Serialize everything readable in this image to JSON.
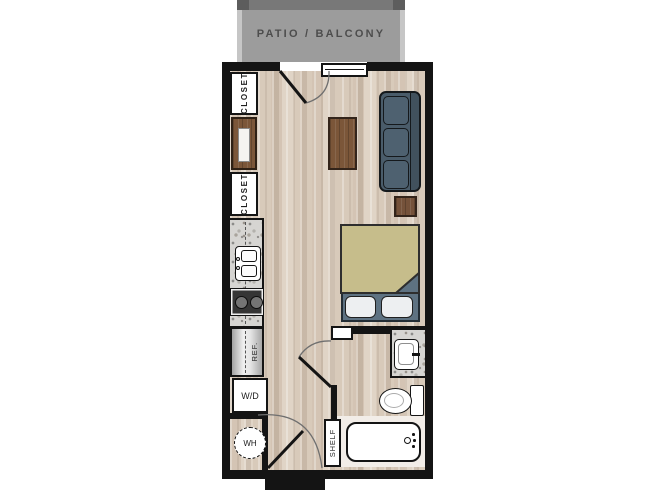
{
  "plan": {
    "patio": {
      "label": "PATIO / BALCONY"
    },
    "closets": [
      {
        "label": "CLOSET"
      },
      {
        "label": "CLOSET"
      }
    ],
    "kitchen": {
      "refrigerator_label": "REF.",
      "washer_dryer_label": "W/D",
      "water_heater_label": "WH"
    },
    "bathroom": {
      "shelf_label": "SHELF"
    }
  },
  "colors": {
    "wall": "#141414",
    "floor_base": "#dccfc0",
    "granite": "#d6d5d2",
    "patio_fill": "#9c9c9c",
    "patio_band": "#787878",
    "patio_text": "#4d4d4d",
    "label_text": "#1d1d1d",
    "sofa": "#4a5c6a",
    "cushion": "#4e6170",
    "bed_blanket": "#c6bd8b",
    "bed_base": "#5e7282",
    "table_wood": "#7b5639",
    "pillow": "#edeff1"
  }
}
